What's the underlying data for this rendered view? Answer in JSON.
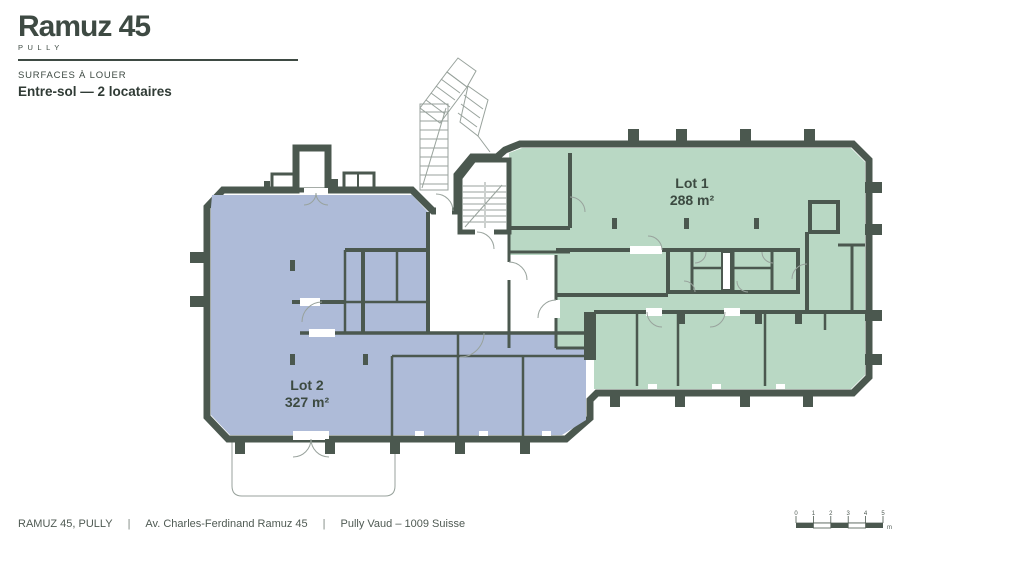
{
  "header": {
    "brand": "Ramuz 45",
    "brand_city": "PULLY",
    "surtitle": "SURFACES À LOUER",
    "title": "Entre-sol — 2 locataires"
  },
  "plan": {
    "lot1": {
      "name": "Lot 1",
      "area": "288 m²",
      "color": "#b9d8c4"
    },
    "lot2": {
      "name": "Lot 2",
      "area": "327 m²",
      "color": "#aebbd8"
    },
    "wall_color": "#4b584f"
  },
  "footer": {
    "separator": "|",
    "items": [
      "RAMUZ 45, PULLY",
      "Av. Charles-Ferdinand Ramuz 45",
      "Pully Vaud – 1009 Suisse"
    ]
  },
  "scalebar": {
    "labels": [
      "0",
      "1",
      "2",
      "3",
      "4",
      "5"
    ],
    "unit": "m"
  }
}
